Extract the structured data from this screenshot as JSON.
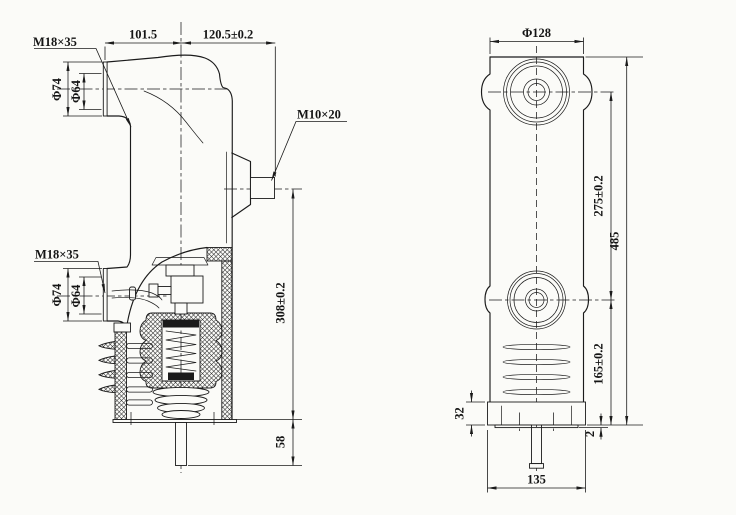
{
  "drawing": {
    "colors": {
      "line": "#1b1b1b",
      "background": "#fbfbf8"
    },
    "left_view": {
      "upper_terminal_thread": "M18×35",
      "upper_outer_diameter": "Φ74",
      "upper_inner_diameter": "Φ64",
      "arm_length": "101.5",
      "body_width": "120.5±0.2",
      "side_terminal_thread": "M10×20",
      "lower_terminal_thread": "M18×35",
      "lower_outer_diameter": "Φ74",
      "lower_inner_diameter": "Φ64",
      "terminal_axis_to_base": "308±0.2",
      "rod_extension": "58"
    },
    "right_view": {
      "boss_diameter": "Φ128",
      "terminal_center_spacing": "275±0.2",
      "overall_height": "485",
      "lower_center_to_base": "165±0.2",
      "flange_height": "32",
      "flange_lip": "2",
      "base_width": "135"
    }
  }
}
